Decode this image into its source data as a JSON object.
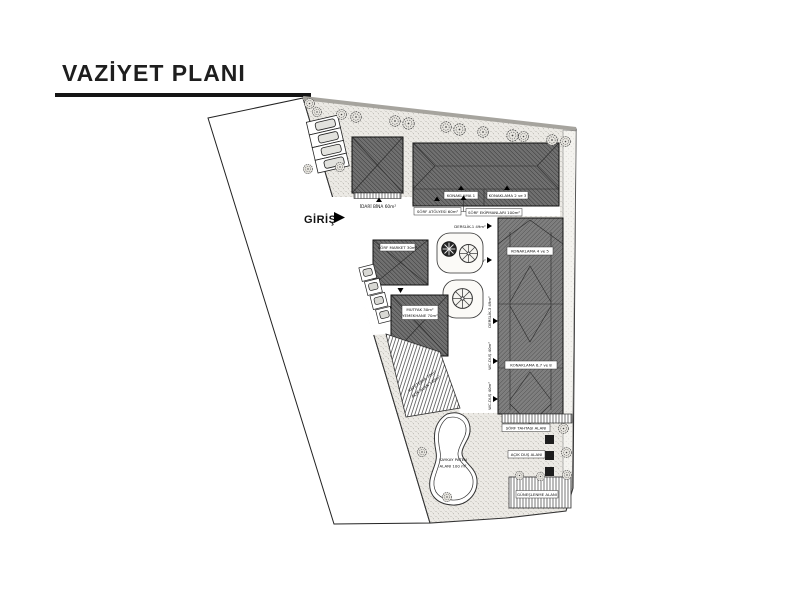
{
  "title": "VAZİYET PLANI",
  "plan": {
    "entrance": "GİRİŞ",
    "labels": {
      "idari_bina": "İDARİ BİNA 60m²",
      "konaklama_1": "KONAKLAMA 1",
      "konaklama_2_3": "KONAKLAMA 2 ve 3",
      "sorf_atolyesi": "SÖRF ATÖLYESİ 60m²",
      "sorf_ekipmanlari": "SÖRF EKİPMANLARI 100m²",
      "derslik_1": "DERSLİK-1 49m²",
      "derslik_2": "DERSLİK-2 49m²",
      "derslik_3": "DERSLİK-3 49m²",
      "wc_dus_a": "WC-DUŞ 40m²",
      "wc_dus_b": "WC-DUŞ 40m²",
      "konaklama_4_5": "KONAKLAMA 4 ve 5",
      "konaklama_6_7_8": "KONAKLAMA 6,7 ve 8",
      "sorf_market": "SÖRF MARKET 30m²",
      "mutfak": "MUTFAK 30m²",
      "yemekhane": "YEMEKHANE 70m²",
      "kafeterya": "KAFETERYA 70m²",
      "acik_alan": "AÇIK ALAN 140m²",
      "kaykay_line1": "KAYKAY PATEN",
      "kaykay_line2": "ALANI 100 m²",
      "sorf_tahtasi": "SÖRF TAHTASI ALANI",
      "acik_dus": "AÇIK DUŞ ALANI",
      "guneslenme": "GÜNEŞLENME ALANI"
    },
    "colors": {
      "ground": "#eceae5",
      "roof": "#7d7d7d",
      "outline": "#1a1a1a"
    }
  }
}
